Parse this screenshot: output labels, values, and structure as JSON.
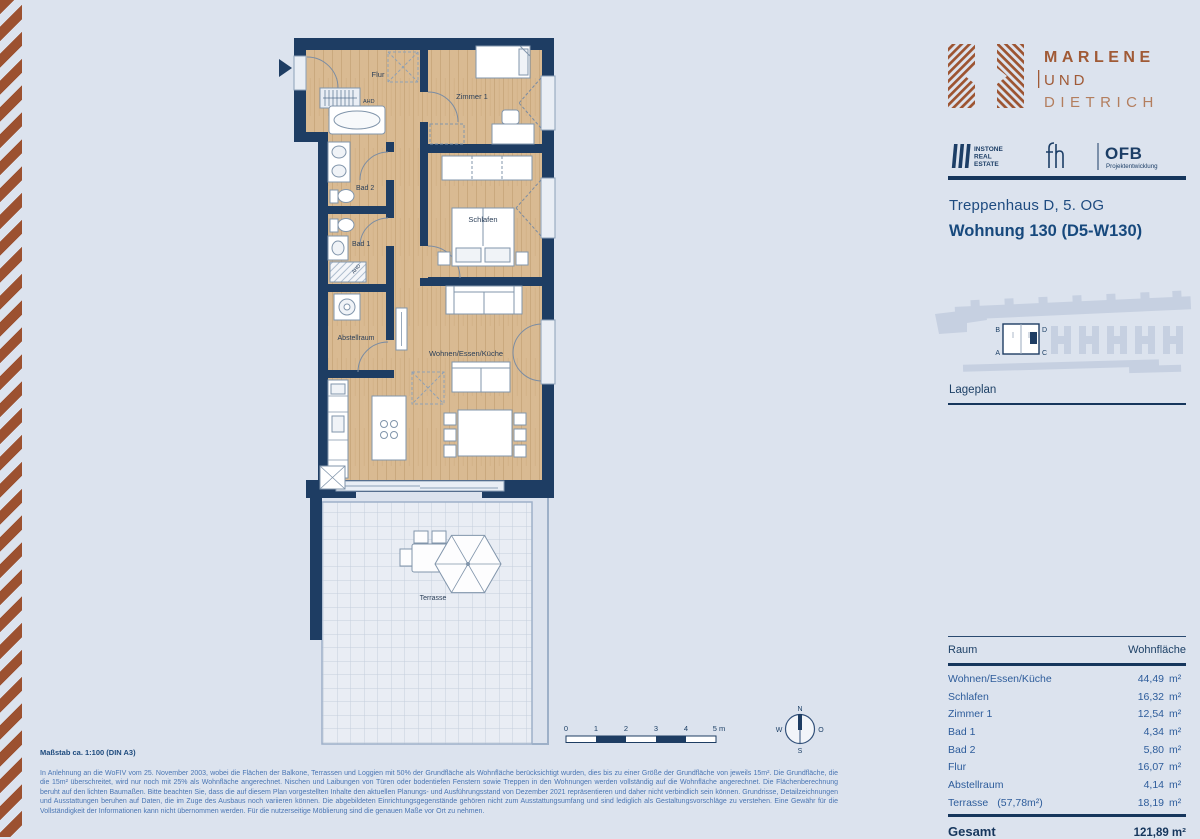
{
  "branding": {
    "wordmark_line1": "MARLENE",
    "wordmark_line2": "UND",
    "wordmark_line3": "DIETRICH",
    "instone_line1": "INSTONE",
    "instone_line2": "REAL",
    "instone_line3": "ESTATE",
    "ofb": "OFB",
    "ofb_sub": "Projektentwicklung"
  },
  "colors": {
    "rust": "#9c5130",
    "navy": "#16365c",
    "wood": "#d9ba92"
  },
  "header": {
    "staircase": "Treppenhaus D, 5. OG",
    "unit": "Wohnung 130 (D5-W130)"
  },
  "siteplan": {
    "label": "Lageplan",
    "corner_tl": "B",
    "corner_tr": "D",
    "corner_bl": "A",
    "corner_br": "C"
  },
  "floorplan": {
    "flur": "Flur",
    "zimmer1": "Zimmer 1",
    "bad2": "Bad 2",
    "bad1": "Bad 1",
    "schlafen": "Schlafen",
    "abstellraum": "Abstellraum",
    "wohnen": "Wohnen/Essen/Küche",
    "terrasse": "Terrasse",
    "ahd1": "AHD",
    "ahd2": "AHD"
  },
  "scalebar": {
    "t0": "0",
    "t1": "1",
    "t2": "2",
    "t3": "3",
    "t4": "4",
    "t5": "5 m"
  },
  "compass": {
    "n": "N",
    "w": "W",
    "o": "O",
    "s": "S"
  },
  "table": {
    "col_room": "Raum",
    "col_area": "Wohnfläche",
    "rows": [
      {
        "room": "Wohnen/Essen/Küche",
        "note": "",
        "value": "44,49",
        "unit": "m²"
      },
      {
        "room": "Schlafen",
        "note": "",
        "value": "16,32",
        "unit": "m²"
      },
      {
        "room": "Zimmer 1",
        "note": "",
        "value": "12,54",
        "unit": "m²"
      },
      {
        "room": "Bad 1",
        "note": "",
        "value": "4,34",
        "unit": "m²"
      },
      {
        "room": "Bad 2",
        "note": "",
        "value": "5,80",
        "unit": "m²"
      },
      {
        "room": "Flur",
        "note": "",
        "value": "16,07",
        "unit": "m²"
      },
      {
        "room": "Abstellraum",
        "note": "",
        "value": "4,14",
        "unit": "m²"
      },
      {
        "room": "Terrasse",
        "note": "(57,78m²)",
        "value": "18,19",
        "unit": "m²"
      }
    ],
    "total_label": "Gesamt",
    "total_value": "121,89 m²"
  },
  "footer": {
    "scale_note": "Maßstab ca. 1:100 (DIN A3)",
    "disclaimer": "In Anlehnung an die WoFIV vom 25. November 2003, wobei die Flächen der Balkone, Terrassen und Loggien mit 50% der Grundfläche als Wohnfläche berücksichtigt wurden, dies bis zu einer Größe der Grundfläche von jeweils 15m². Die Grundfläche, die die 15m² überschreitet, wird nur noch mit 25% als Wohnfläche angerechnet. Nischen und Laibungen von Türen oder bodentiefen Fenstern sowie Treppen in den Wohnungen werden vollständig auf die Wohnfläche angerechnet. Die Flächenberechnung beruht auf den lichten Baumaßen. Bitte beachten Sie, dass die auf diesem Plan vorgestellten Inhalte den aktuellen Planungs- und Ausführungsstand von Dezember 2021 repräsentieren und daher nicht verbindlich sein können. Grundrisse, Detailzeichnungen und Ausstattungen beruhen auf Daten, die im Zuge des Ausbaus noch variieren können. Die abgebildeten Einrichtungsgegenstände gehören nicht zum Ausstattungsumfang und sind lediglich als Gestaltungsvorschläge zu verstehen. Eine Gewähr für die Vollständigkeit der Informationen kann nicht übernommen werden. Für die nutzerseitige Möblierung sind die genauen Maße vor Ort zu nehmen."
  }
}
